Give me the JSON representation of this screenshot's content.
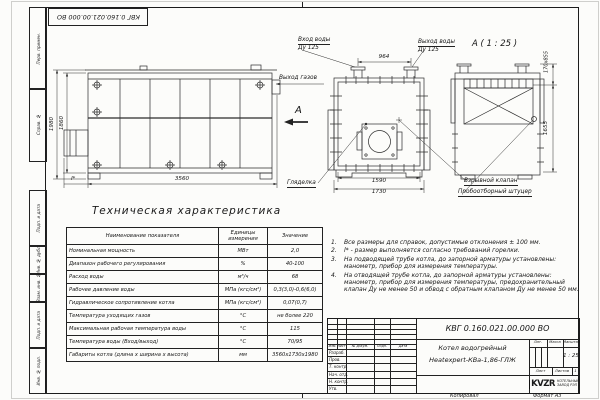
{
  "sheet": {
    "stamp_top": "КВГ 0.160.021.00.000 ВО",
    "margin_labels": [
      "Перв. примен.",
      "Справ. №",
      "Подп. и дата",
      "Инв. № дубл.",
      "Взам. инв. №",
      "Подп. и дата",
      "Инв. № подл."
    ],
    "footer": {
      "copied": "Копировал",
      "format": "Формат А3"
    }
  },
  "views": {
    "side": {
      "dim_height_outer": "1980",
      "dim_height_inner": "1860",
      "dim_length": "3560",
      "dim_burner": "l*"
    },
    "front": {
      "dim_flanges": "964",
      "dim_width_inner": "1590",
      "dim_width_outer": "1730",
      "water_in_1": "Вход воды",
      "water_in_2": "Ду 125",
      "water_out_1": "Выход воды",
      "water_out_2": "Ду 125",
      "gas_out": "Выход газов",
      "view_arrow": "А",
      "sight_glass": "Гляделка"
    },
    "detail": {
      "title": "А ( 1 : 25 )",
      "dim_top": "170х855",
      "dim_height": "1655",
      "explosion_valve": "Взрывной клапан",
      "sampling": "Пробоотборный штуцер"
    }
  },
  "spec": {
    "title": "Техническая характеристика",
    "col_name": "Наименование показателя",
    "col_unit": "Единицы измерения",
    "col_value": "Значение",
    "rows": [
      {
        "name": "Номинальная мощность",
        "unit": "МВт",
        "value": "2,0"
      },
      {
        "name": "Диапазон рабочего регулирования",
        "unit": "%",
        "value": "40-100"
      },
      {
        "name": "Расход воды",
        "unit": "м³/ч",
        "value": "68"
      },
      {
        "name": "Рабочее давление воды",
        "unit": "МПа (кгс/см²)",
        "value": "0,3(3,0)-0,6(6,0)"
      },
      {
        "name": "Гидравлическое сопротивление котла",
        "unit": "МПа (кгс/см²)",
        "value": "0,07(0,7)"
      },
      {
        "name": "Температура уходящих газов",
        "unit": "°С",
        "value": "не более 220"
      },
      {
        "name": "Максимальная рабочая температура воды",
        "unit": "°С",
        "value": "115"
      },
      {
        "name": "Температура воды (Вход/выход)",
        "unit": "°С",
        "value": "70/95"
      },
      {
        "name": "Габариты котла (длина х ширина х высота)",
        "unit": "мм",
        "value": "3560х1730х1980"
      }
    ]
  },
  "notes": [
    {
      "num": "1.",
      "text": "Все размеры для справок, допустимые отклонения ± 100 мм."
    },
    {
      "num": "2.",
      "text": "l* - размер выполняется согласно требований горелки."
    },
    {
      "num": "3.",
      "text": "На подводящей трубе котла, до запорной арматуры установлены: манометр, прибор для измерения температуры."
    },
    {
      "num": "4.",
      "text": "На отводящей трубе котла, до запорной арматуры установлены: манометр, прибор для измерения температуры, предохранительный клапан Ду не менее 50 и обвод с обратным клапаном Ду не менее 50 мм."
    }
  ],
  "title_block": {
    "doc_number": "КВГ 0.160.021.00.000 ВО",
    "product_line1": "Котел водогрейный",
    "product_line2": "Heatexpert-КВа-1,86-ГЛЖ",
    "lit_label": "Лит.",
    "mass_label": "Масса",
    "scale_label": "Масштаб",
    "scale_value": "1 : 25",
    "sheet_label": "Лист",
    "sheets_label": "Листов",
    "sheets_value": "1",
    "rev_headers": [
      "Изм.",
      "Лист",
      "№ докум.",
      "Подп.",
      "Дата"
    ],
    "sig_rows": [
      "Разраб.",
      "Пров.",
      "Т. контр.",
      "Нач. отд.",
      "Н. контр.",
      "Утв."
    ],
    "logo_text": "KVZR",
    "logo_sub1": "КОТЕЛЬНЫЙ",
    "logo_sub2": "ЗАВОД РЭП"
  }
}
